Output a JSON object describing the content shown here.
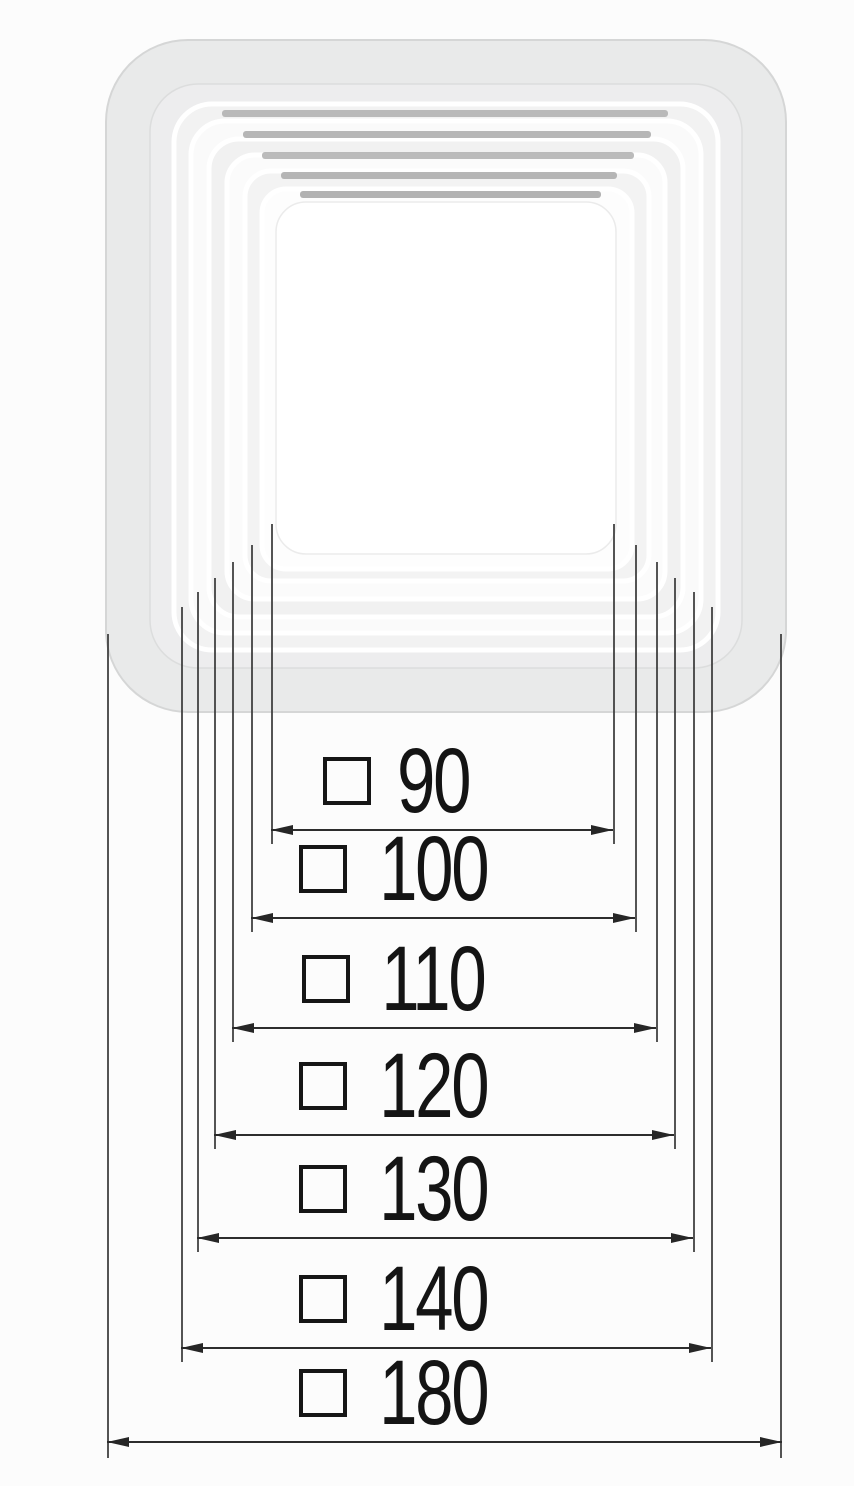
{
  "figure": {
    "kind": "technical-dimension-diagram",
    "description": "Set of nested square mounting frames shown above stacked dimension lines",
    "section_symbol": "□",
    "line_color": "#2d2d2d",
    "extension_line_color": "#3c3c3c"
  },
  "product": {
    "name": "nested-square-frames",
    "outer_plate_color": "#e9eaea",
    "ring_light_color": "#fbfbfb",
    "ring_gray_color": "#f2f2f2",
    "slot_bar_color": "#afafaf",
    "frame_sizes": [
      "90",
      "100",
      "110",
      "120",
      "130",
      "140",
      "180"
    ]
  },
  "dimensions": {
    "rows": [
      {
        "symbol": "□",
        "value": "90"
      },
      {
        "symbol": "□",
        "value": "100"
      },
      {
        "symbol": "□",
        "value": "110"
      },
      {
        "symbol": "□",
        "value": "120"
      },
      {
        "symbol": "□",
        "value": "130"
      },
      {
        "symbol": "□",
        "value": "140"
      },
      {
        "symbol": "□",
        "value": "180"
      }
    ]
  }
}
